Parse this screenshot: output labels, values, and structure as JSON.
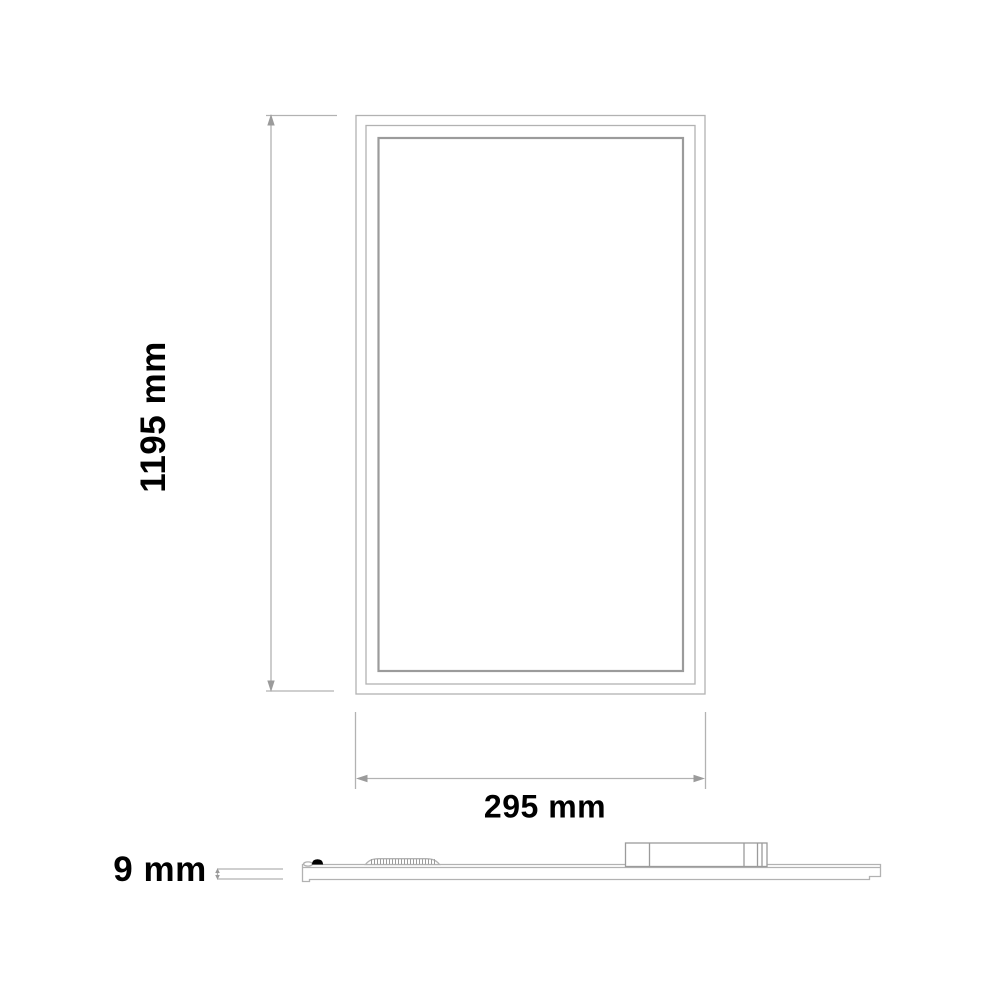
{
  "drawing": {
    "front_view": {
      "height_label": "1195 mm",
      "width_label": "295 mm"
    },
    "side_view": {
      "thickness_label": "9 mm"
    }
  },
  "colors": {
    "background": "#ffffff",
    "line": "#b2b2b2",
    "line_dark": "#9b9b9b",
    "text": "#000000"
  }
}
